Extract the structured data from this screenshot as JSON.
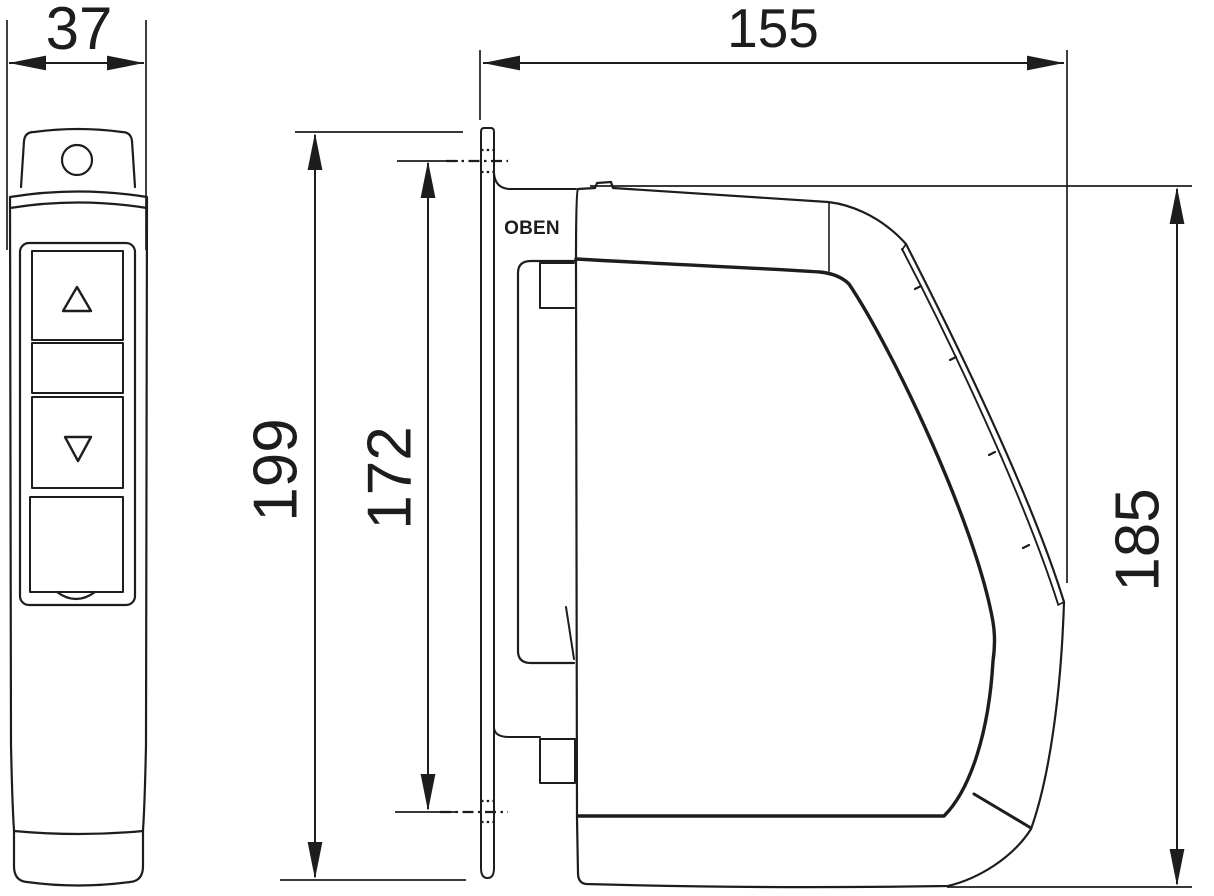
{
  "drawing": {
    "background": "#ffffff",
    "line_color": "#1d1d1b",
    "views": {
      "left": "remote-control-front-view",
      "right": "drive-unit-side-view"
    },
    "dimensions": {
      "remote_width": "37",
      "unit_depth": "155",
      "mount_plate_height": "199",
      "hole_spacing": "172",
      "unit_height": "185"
    },
    "labels": {
      "top_marking": "OBEN"
    }
  }
}
